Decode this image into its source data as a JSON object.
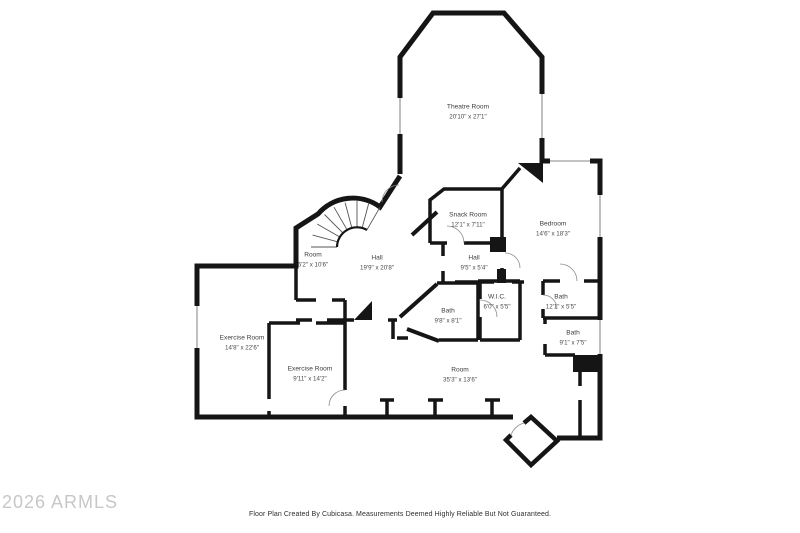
{
  "watermark": "2026 ARMLS",
  "footer": "Floor Plan Created By Cubicasa. Measurements Deemed Highly Reliable But Not Guaranteed.",
  "colors": {
    "wall": "#151515",
    "window": "#9f9f9f",
    "door_arc": "#8a8a8a",
    "stair_tread": "#555555",
    "label_text": "#3c3c3c",
    "watermark": "#c7c7c7",
    "background": "#ffffff"
  },
  "rooms": [
    {
      "id": "theatre-room",
      "name": "Theatre Room",
      "dims": "20'10\" x 27'1\""
    },
    {
      "id": "snack-room",
      "name": "Snack Room",
      "dims": "12'1\" x 7'11\""
    },
    {
      "id": "bedroom",
      "name": "Bedroom",
      "dims": "14'6\" x 18'3\""
    },
    {
      "id": "room-small",
      "name": "Room",
      "dims": "6'2\" x 10'6\""
    },
    {
      "id": "hall-main",
      "name": "Hall",
      "dims": "19'9\" x 20'8\""
    },
    {
      "id": "hall-small",
      "name": "Hall",
      "dims": "9'5\" x 5'4\""
    },
    {
      "id": "wic",
      "name": "W.I.C.",
      "dims": "6'0\" x 5'5\""
    },
    {
      "id": "bath-upper-right",
      "name": "Bath",
      "dims": "12'1\" x 5'5\""
    },
    {
      "id": "bath-center",
      "name": "Bath",
      "dims": "9'8\" x 8'1\""
    },
    {
      "id": "exercise-room-large",
      "name": "Exercise Room",
      "dims": "14'8\" x 22'6\""
    },
    {
      "id": "bath-lower-right",
      "name": "Bath",
      "dims": "9'1\" x 7'5\""
    },
    {
      "id": "exercise-room-small",
      "name": "Exercise Room",
      "dims": "9'11\" x 14'2\""
    },
    {
      "id": "room-large",
      "name": "Room",
      "dims": "35'3\" x 13'6\""
    }
  ]
}
